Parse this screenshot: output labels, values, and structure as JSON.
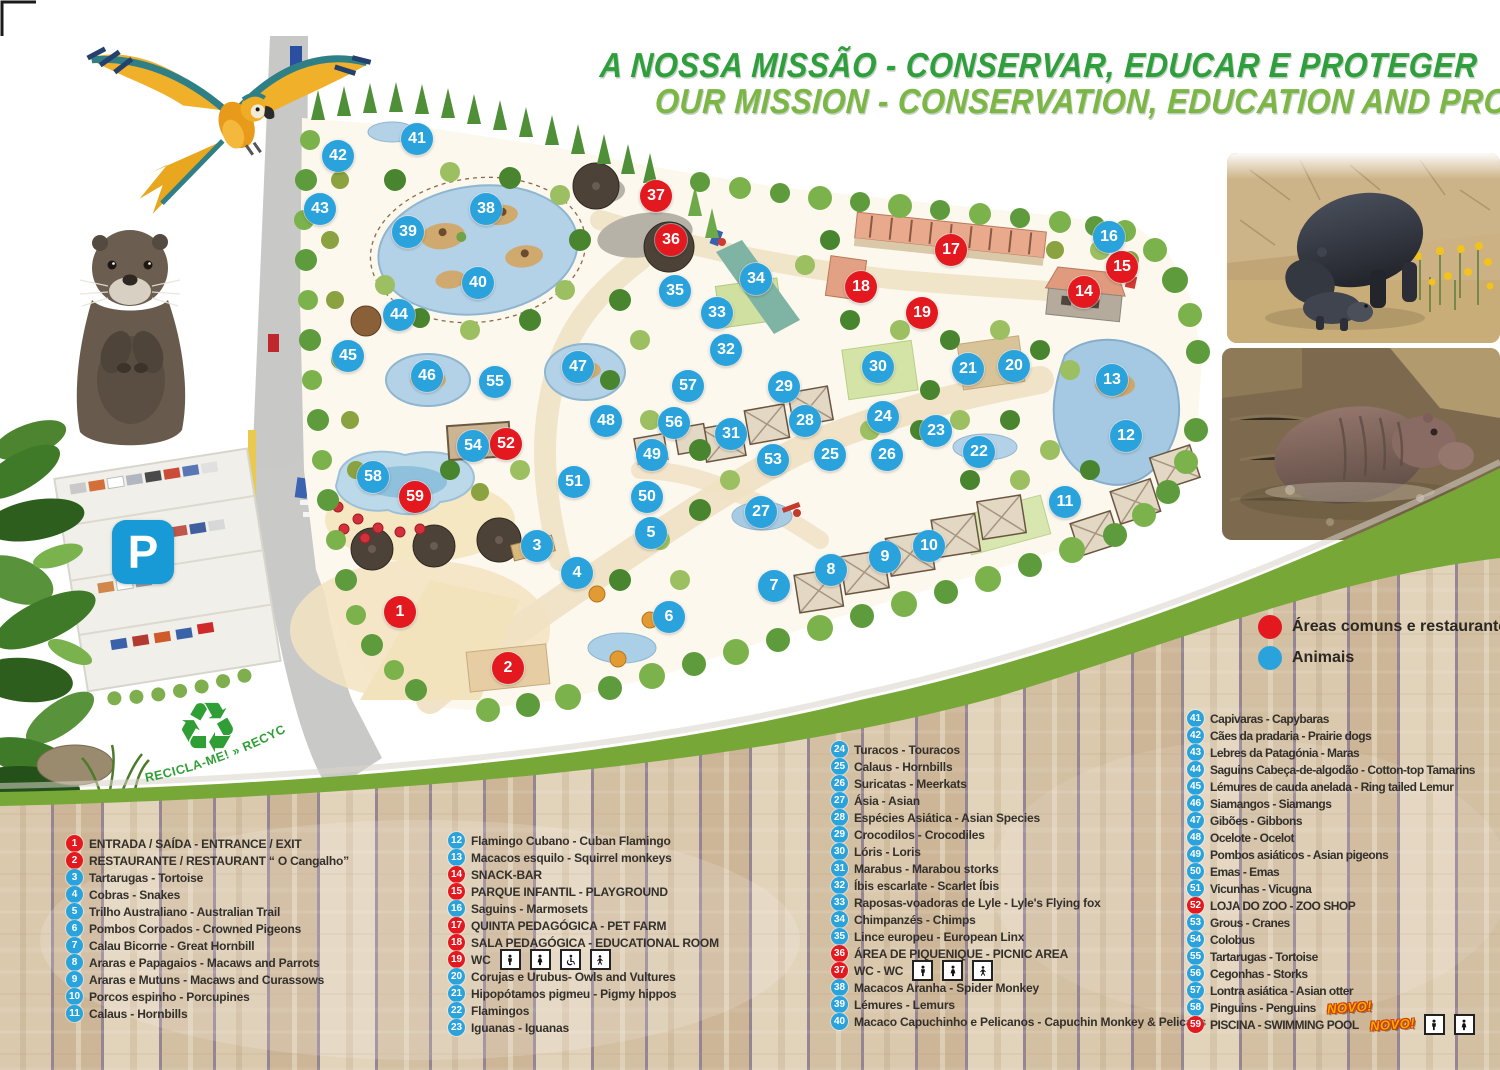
{
  "title": {
    "line1": "A NOSSA MISSÃO - CONSERVAR, EDUCAR E PROTEGER",
    "line2": "OUR MISSION - CONSERVATION, EDUCATION AND PROTECTION"
  },
  "key": {
    "common_label": "Áreas comuns e restaurantes",
    "animals_label": "Animais"
  },
  "parking": {
    "sign": "P"
  },
  "recycle": {
    "symbol": "♻",
    "label": "RECICLA-ME! » RECYCLE ME!"
  },
  "badges": {
    "new_label": "NOVO!"
  },
  "colors": {
    "animal_marker_blue": "#2aa3dd",
    "common_marker_red": "#e3191f",
    "swoosh_green": "#76a737",
    "title_green_dark": "#2f9e3c",
    "title_green_light": "#7cb644",
    "parking_blue": "#189ad6"
  },
  "map": {
    "markers": [
      {
        "n": 1,
        "x": 400,
        "y": 612,
        "t": "c"
      },
      {
        "n": 2,
        "x": 508,
        "y": 668,
        "t": "c"
      },
      {
        "n": 3,
        "x": 537,
        "y": 546,
        "t": "a"
      },
      {
        "n": 4,
        "x": 577,
        "y": 573,
        "t": "a"
      },
      {
        "n": 5,
        "x": 651,
        "y": 533,
        "t": "a"
      },
      {
        "n": 6,
        "x": 669,
        "y": 617,
        "t": "a"
      },
      {
        "n": 7,
        "x": 774,
        "y": 586,
        "t": "a"
      },
      {
        "n": 8,
        "x": 831,
        "y": 570,
        "t": "a"
      },
      {
        "n": 9,
        "x": 885,
        "y": 557,
        "t": "a"
      },
      {
        "n": 10,
        "x": 929,
        "y": 546,
        "t": "a"
      },
      {
        "n": 11,
        "x": 1065,
        "y": 502,
        "t": "a"
      },
      {
        "n": 12,
        "x": 1126,
        "y": 436,
        "t": "a"
      },
      {
        "n": 13,
        "x": 1112,
        "y": 380,
        "t": "a"
      },
      {
        "n": 14,
        "x": 1084,
        "y": 292,
        "t": "c"
      },
      {
        "n": 15,
        "x": 1122,
        "y": 267,
        "t": "c"
      },
      {
        "n": 16,
        "x": 1109,
        "y": 237,
        "t": "a"
      },
      {
        "n": 17,
        "x": 951,
        "y": 250,
        "t": "c"
      },
      {
        "n": 18,
        "x": 861,
        "y": 287,
        "t": "c"
      },
      {
        "n": 19,
        "x": 922,
        "y": 313,
        "t": "c"
      },
      {
        "n": 20,
        "x": 1014,
        "y": 366,
        "t": "a"
      },
      {
        "n": 21,
        "x": 968,
        "y": 369,
        "t": "a"
      },
      {
        "n": 22,
        "x": 979,
        "y": 452,
        "t": "a"
      },
      {
        "n": 23,
        "x": 936,
        "y": 431,
        "t": "a"
      },
      {
        "n": 24,
        "x": 883,
        "y": 417,
        "t": "a"
      },
      {
        "n": 25,
        "x": 830,
        "y": 455,
        "t": "a"
      },
      {
        "n": 26,
        "x": 887,
        "y": 455,
        "t": "a"
      },
      {
        "n": 27,
        "x": 761,
        "y": 512,
        "t": "a"
      },
      {
        "n": 28,
        "x": 805,
        "y": 421,
        "t": "a"
      },
      {
        "n": 29,
        "x": 784,
        "y": 387,
        "t": "a"
      },
      {
        "n": 30,
        "x": 878,
        "y": 367,
        "t": "a"
      },
      {
        "n": 31,
        "x": 731,
        "y": 434,
        "t": "a"
      },
      {
        "n": 32,
        "x": 726,
        "y": 350,
        "t": "a"
      },
      {
        "n": 33,
        "x": 717,
        "y": 313,
        "t": "a"
      },
      {
        "n": 34,
        "x": 756,
        "y": 279,
        "t": "a"
      },
      {
        "n": 35,
        "x": 675,
        "y": 291,
        "t": "a"
      },
      {
        "n": 36,
        "x": 671,
        "y": 240,
        "t": "c"
      },
      {
        "n": 37,
        "x": 656,
        "y": 196,
        "t": "c"
      },
      {
        "n": 38,
        "x": 486,
        "y": 209,
        "t": "a"
      },
      {
        "n": 39,
        "x": 408,
        "y": 232,
        "t": "a"
      },
      {
        "n": 40,
        "x": 478,
        "y": 283,
        "t": "a"
      },
      {
        "n": 41,
        "x": 417,
        "y": 139,
        "t": "a"
      },
      {
        "n": 42,
        "x": 338,
        "y": 156,
        "t": "a"
      },
      {
        "n": 43,
        "x": 320,
        "y": 209,
        "t": "a"
      },
      {
        "n": 44,
        "x": 399,
        "y": 315,
        "t": "a"
      },
      {
        "n": 45,
        "x": 348,
        "y": 356,
        "t": "a"
      },
      {
        "n": 46,
        "x": 427,
        "y": 376,
        "t": "a"
      },
      {
        "n": 47,
        "x": 578,
        "y": 367,
        "t": "a"
      },
      {
        "n": 48,
        "x": 606,
        "y": 421,
        "t": "a"
      },
      {
        "n": 49,
        "x": 652,
        "y": 455,
        "t": "a"
      },
      {
        "n": 50,
        "x": 647,
        "y": 497,
        "t": "a"
      },
      {
        "n": 51,
        "x": 574,
        "y": 482,
        "t": "a"
      },
      {
        "n": 52,
        "x": 506,
        "y": 444,
        "t": "c"
      },
      {
        "n": 53,
        "x": 773,
        "y": 460,
        "t": "a"
      },
      {
        "n": 54,
        "x": 473,
        "y": 446,
        "t": "a"
      },
      {
        "n": 55,
        "x": 495,
        "y": 382,
        "t": "a"
      },
      {
        "n": 56,
        "x": 674,
        "y": 423,
        "t": "a"
      },
      {
        "n": 57,
        "x": 688,
        "y": 386,
        "t": "a"
      },
      {
        "n": 58,
        "x": 373,
        "y": 477,
        "t": "a"
      },
      {
        "n": 59,
        "x": 415,
        "y": 497,
        "t": "c"
      }
    ]
  },
  "legend": {
    "columns": [
      {
        "items": [
          {
            "n": 1,
            "t": "c",
            "label": "ENTRADA / SAÍDA - ENTRANCE / EXIT"
          },
          {
            "n": 2,
            "t": "c",
            "label": "RESTAURANTE / RESTAURANT “ O Cangalho”"
          },
          {
            "n": 3,
            "t": "a",
            "label": "Tartarugas - Tortoise"
          },
          {
            "n": 4,
            "t": "a",
            "label": "Cobras - Snakes"
          },
          {
            "n": 5,
            "t": "a",
            "label": "Trilho Australiano - Australian Trail"
          },
          {
            "n": 6,
            "t": "a",
            "label": "Pombos Coroados - Crowned Pigeons"
          },
          {
            "n": 7,
            "t": "a",
            "label": "Calau Bicorne - Great Hornbill"
          },
          {
            "n": 8,
            "t": "a",
            "label": "Araras e Papagaios - Macaws and Parrots"
          },
          {
            "n": 9,
            "t": "a",
            "label": "Araras e Mutuns - Macaws and Curassows"
          },
          {
            "n": 10,
            "t": "a",
            "label": "Porcos espinho - Porcupines"
          },
          {
            "n": 11,
            "t": "a",
            "label": "Calaus - Hornbills"
          }
        ]
      },
      {
        "items": [
          {
            "n": 12,
            "t": "a",
            "label": "Flamingo Cubano - Cuban Flamingo"
          },
          {
            "n": 13,
            "t": "a",
            "label": "Macacos esquilo - Squirrel monkeys"
          },
          {
            "n": 14,
            "t": "c",
            "label": "SNACK-BAR"
          },
          {
            "n": 15,
            "t": "c",
            "label": "PARQUE INFANTIL - PLAYGROUND"
          },
          {
            "n": 16,
            "t": "a",
            "label": "Saguins - Marmosets"
          },
          {
            "n": 17,
            "t": "c",
            "label": "QUINTA PEDAGÓGICA - PET FARM"
          },
          {
            "n": 18,
            "t": "c",
            "label": "SALA PEDAGÓGICA - EDUCATIONAL ROOM"
          },
          {
            "n": 19,
            "t": "c",
            "label": "WC",
            "icons": [
              "man",
              "woman",
              "wheelchair",
              "baby"
            ]
          },
          {
            "n": 20,
            "t": "a",
            "label": "Corujas e Urubus- Owls and Vultures"
          },
          {
            "n": 21,
            "t": "a",
            "label": "Hipopótamos pigmeu - Pigmy hippos"
          },
          {
            "n": 22,
            "t": "a",
            "label": "Flamingos"
          },
          {
            "n": 23,
            "t": "a",
            "label": "Iguanas - Iguanas"
          }
        ]
      },
      {
        "items": [
          {
            "n": 24,
            "t": "a",
            "label": "Turacos - Touracos"
          },
          {
            "n": 25,
            "t": "a",
            "label": "Calaus - Hornbills"
          },
          {
            "n": 26,
            "t": "a",
            "label": "Suricatas - Meerkats"
          },
          {
            "n": 27,
            "t": "a",
            "label": "Ásia - Asian"
          },
          {
            "n": 28,
            "t": "a",
            "label": "Espécies Asiática - Asian Species"
          },
          {
            "n": 29,
            "t": "a",
            "label": "Crocodilos - Crocodiles"
          },
          {
            "n": 30,
            "t": "a",
            "label": "Lóris - Loris"
          },
          {
            "n": 31,
            "t": "a",
            "label": "Marabus - Marabou storks"
          },
          {
            "n": 32,
            "t": "a",
            "label": "Íbis escarlate - Scarlet Íbis"
          },
          {
            "n": 33,
            "t": "a",
            "label": "Raposas-voadoras de Lyle - Lyle's Flying fox"
          },
          {
            "n": 34,
            "t": "a",
            "label": "Chimpanzés - Chimps"
          },
          {
            "n": 35,
            "t": "a",
            "label": "Lince europeu - European Linx"
          },
          {
            "n": 36,
            "t": "c",
            "label": "ÁREA DE PIQUENIQUE - PICNIC AREA"
          },
          {
            "n": 37,
            "t": "c",
            "label": "WC - WC",
            "icons": [
              "man",
              "woman",
              "baby"
            ]
          },
          {
            "n": 38,
            "t": "a",
            "label": "Macacos Aranha - Spider Monkey"
          },
          {
            "n": 39,
            "t": "a",
            "label": "Lémures - Lemurs"
          },
          {
            "n": 40,
            "t": "a",
            "label": "Macaco Capuchinho e Pelicanos - Capuchin Monkey & Pelicans"
          }
        ]
      },
      {
        "items": [
          {
            "n": 41,
            "t": "a",
            "label": "Capivaras - Capybaras"
          },
          {
            "n": 42,
            "t": "a",
            "label": "Cães da pradaria - Prairie dogs"
          },
          {
            "n": 43,
            "t": "a",
            "label": "Lebres da Patagónia - Maras"
          },
          {
            "n": 44,
            "t": "a",
            "label": "Saguins Cabeça-de-algodão - Cotton-top Tamarins"
          },
          {
            "n": 45,
            "t": "a",
            "label": "Lémures de cauda anelada - Ring tailed Lemur"
          },
          {
            "n": 46,
            "t": "a",
            "label": "Siamangos - Siamangs"
          },
          {
            "n": 47,
            "t": "a",
            "label": "Gibões - Gibbons"
          },
          {
            "n": 48,
            "t": "a",
            "label": "Ocelote - Ocelot"
          },
          {
            "n": 49,
            "t": "a",
            "label": "Pombos asiáticos - Asian pigeons"
          },
          {
            "n": 50,
            "t": "a",
            "label": "Emas - Emas"
          },
          {
            "n": 51,
            "t": "a",
            "label": "Vicunhas - Vicugna"
          },
          {
            "n": 52,
            "t": "c",
            "label": "LOJA DO ZOO - ZOO SHOP"
          },
          {
            "n": 53,
            "t": "a",
            "label": "Grous - Cranes"
          },
          {
            "n": 54,
            "t": "a",
            "label": "Colobus"
          },
          {
            "n": 55,
            "t": "a",
            "label": "Tartarugas - Tortoise"
          },
          {
            "n": 56,
            "t": "a",
            "label": "Cegonhas - Storks"
          },
          {
            "n": 57,
            "t": "a",
            "label": "Lontra asiática - Asian otter"
          },
          {
            "n": 58,
            "t": "a",
            "label": "Pinguins - Penguins",
            "new": true
          },
          {
            "n": 59,
            "t": "c",
            "label": "PISCINA - SWIMMING POOL",
            "new": true,
            "icons": [
              "man",
              "woman"
            ]
          }
        ]
      }
    ]
  }
}
